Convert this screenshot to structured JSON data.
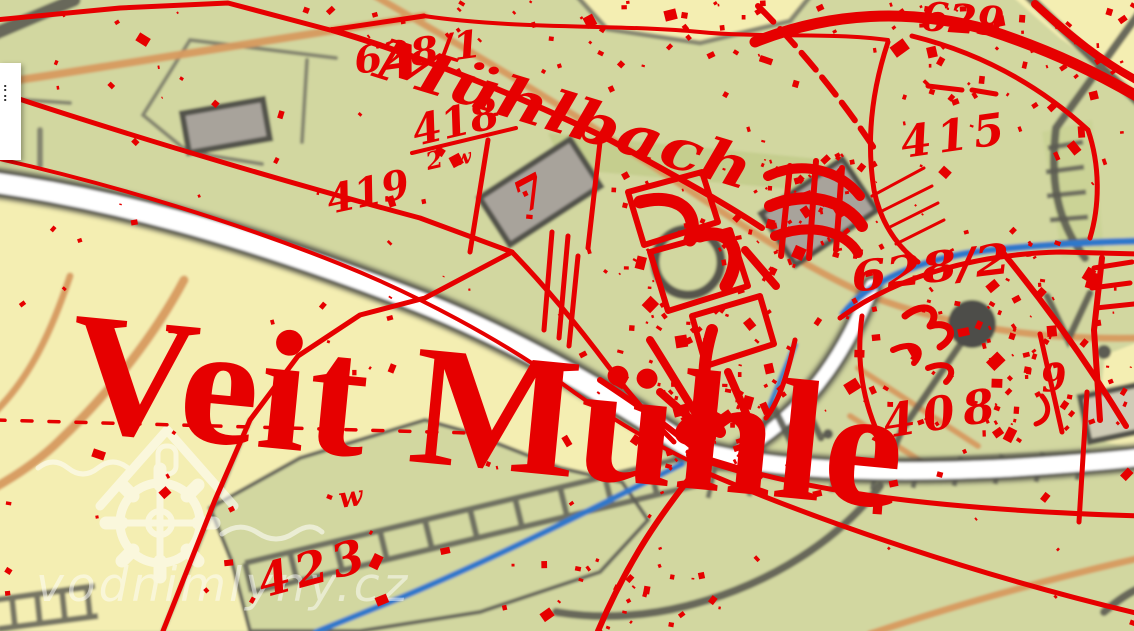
{
  "map": {
    "labels": {
      "place": "Veit Mühle",
      "stream": "Mühlbach"
    },
    "parcels": [
      "628/1",
      "418",
      "2",
      "w",
      "419",
      "629",
      "415",
      "628/2",
      "408",
      "9",
      "423",
      "w",
      "7"
    ],
    "colors": {
      "overlay_red": "#e60000",
      "field_yellow": "#f4eeb2",
      "meadow_green": "#d2d7a0",
      "dark_green": "#c3cd8b",
      "stream_blue": "#2e78cb",
      "path_orange": "#d79a5f",
      "road_casing_gray": "#54544c",
      "building_gray": "#a8a39b",
      "road_white": "#ffffff"
    }
  },
  "watermark": {
    "text": "vodnimlyny.cz"
  },
  "side_panel": {
    "line1": ":",
    "line2": ":"
  }
}
